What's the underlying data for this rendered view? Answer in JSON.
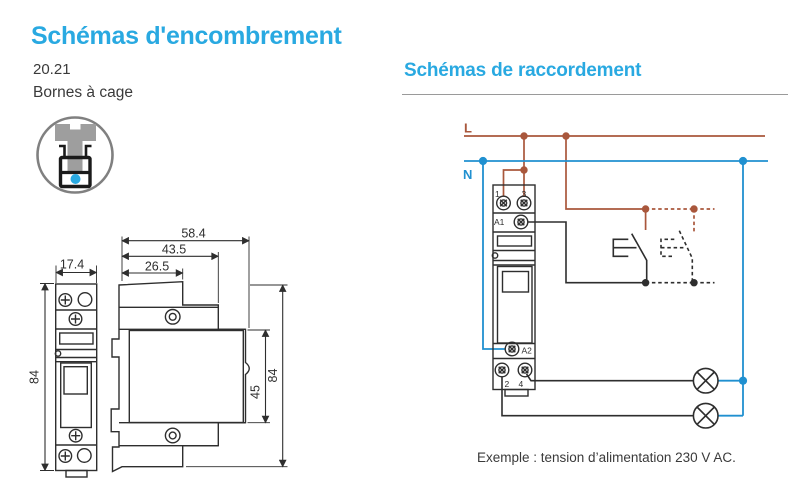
{
  "titles": {
    "left": "Schémas d'encombrement",
    "right": "Schémas de raccordement"
  },
  "product": {
    "model": "20.21",
    "terminals": "Bornes à cage"
  },
  "dims_front": {
    "w": "17.4",
    "h": "84"
  },
  "dims_side": {
    "d1": "58.4",
    "d2": "43.5",
    "d3": "26.5",
    "h": "84",
    "hb": "45"
  },
  "wiring": {
    "phase_label": "L",
    "neutral_label": "N",
    "t1": "1",
    "t3": "3",
    "a1": "A1",
    "a2": "A2",
    "t2": "2",
    "t4": "4",
    "caption": "Exemple : tension d’alimentation 230 V AC."
  },
  "colors": {
    "accent": "#29A9E1",
    "phase": "#A9573C",
    "neutral": "#2090D0",
    "drawing": "#2E2E2E"
  },
  "icon": {
    "name": "cage-terminal-icon",
    "dot_color": "#29A9E1"
  }
}
